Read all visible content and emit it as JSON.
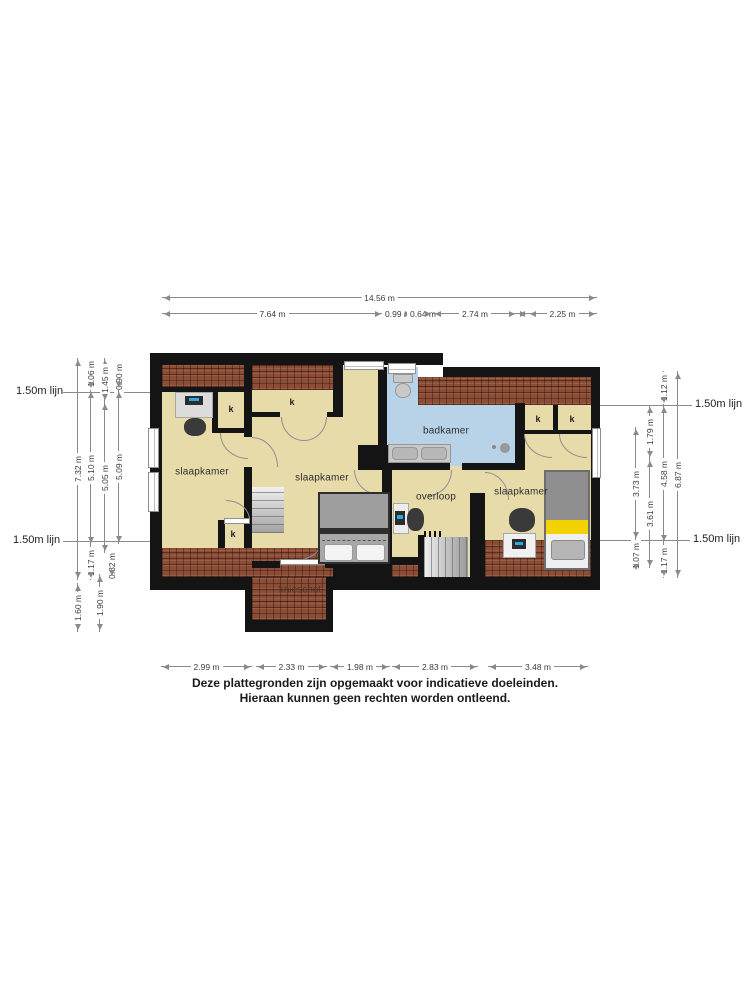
{
  "colors": {
    "wall": "#141414",
    "floor": "#e7dbaa",
    "bathroom": "#b8d2e8",
    "roof_tiles": "#8d4c34",
    "bed_accent_yellow": "#f2d200"
  },
  "rooms": {
    "bedroom": "slaapkamer",
    "bathroom": "badkamer",
    "landing": "overloop",
    "knee_wall": "knieschot",
    "closet": "k"
  },
  "ref": {
    "line150": "1.50m lijn"
  },
  "dims": {
    "top_total": "14.56 m",
    "top": [
      "7.64 m",
      "0.99 m",
      "0.64 m",
      "2.74 m",
      "2.25 m"
    ],
    "bottom": [
      "2.99 m",
      "2.33 m",
      "1.98 m",
      "2.83 m",
      "3.48 m"
    ],
    "left": {
      "l732": "7.32 m",
      "l160": "1.60 m",
      "l106": "1.06 m",
      "l510": "5.10 m",
      "l117": "1.17 m",
      "l190": "1.90 m",
      "l145": "1.45 m",
      "l505": "5.05 m",
      "l082": "0.82 m",
      "l090": "0.90 m",
      "l509": "5.09 m"
    },
    "right": {
      "r373": "3.73 m",
      "r107": "1.07 m",
      "r179": "1.79 m",
      "r361": "3.61 m",
      "r112": "1.12 m",
      "r458": "4.58 m",
      "r117": "1.17 m",
      "r687": "6.87 m"
    }
  },
  "disclaimer": {
    "line1": "Deze plattegronden zijn opgemaakt voor indicatieve doeleinden.",
    "line2": "Hieraan kunnen geen rechten worden ontleend."
  }
}
